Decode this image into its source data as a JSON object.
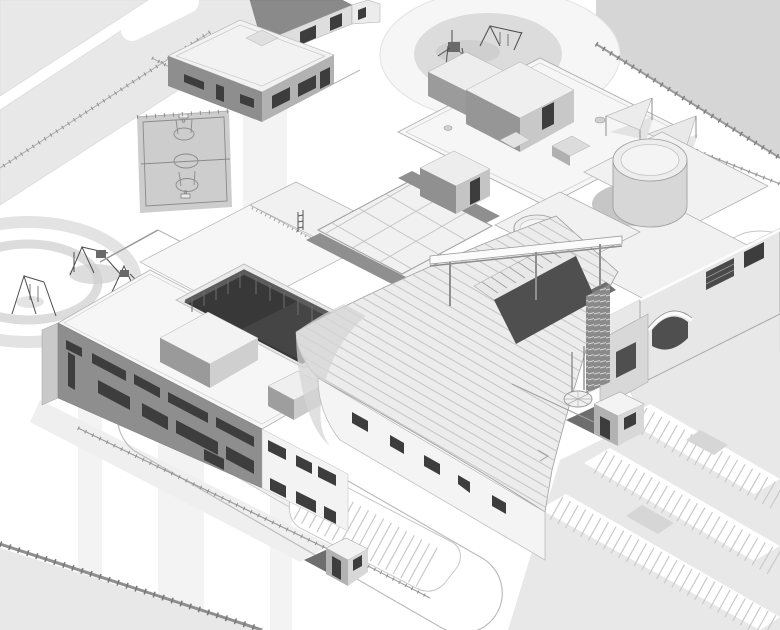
{
  "meta": {
    "title": "School campus — monochrome isometric architectural site render",
    "projection": "isometric axonometric, viewed from the south-east",
    "render_style": "white-model 3D massing render with thin grey line work, no visible text",
    "visible_text": "none"
  },
  "palette": {
    "bg": "#ffffff",
    "road": "#e8e8e8",
    "lot": "#d6d6d6",
    "stripe": "#f3f3f3",
    "ground-shadow": "#efefef",
    "court": "#cdcdcd",
    "court-line": "#8a8a8a",
    "ring": "#e3e3e3",
    "ring-inner": "#dcdcdc",
    "roof-white": "#f6f6f6",
    "roof-light": "#f1f1f1",
    "roof-mid": "#ececec",
    "facade-white": "#f4f4f4",
    "wall-dark": "#8e8e8e",
    "wall-mid": "#b2b2b2",
    "wall-light": "#d8d8d8",
    "wall-pale": "#e7e7e7",
    "glass-dark": "#3d3d3d",
    "courtyard-dark": "#383838",
    "recess-dark": "#4f4f4f",
    "drum-side": "#d7d7d7",
    "drum-top": "#ededed",
    "line": "#9a9a9a",
    "edge": "#b5b5b5",
    "fence": "#8f8f8f",
    "equipment": "#4d4d4d",
    "rib-line": "#c6c6c6",
    "grid-line": "#b9b9b9",
    "tick": "#c9c9c9",
    "booth-shadow": "#6e6e6e"
  },
  "features": {
    "scene": "School campus — monochrome isometric architectural site render",
    "west_wing": "West classroom wing, two-story block with dark facade and ribbon windows",
    "courtyard": "Sunken central courtyard with dark curtain-wall glazing",
    "atrium": "Glazed atrium court with skylight grid and parapet bands",
    "gym": "Gymnasium hall with curved ribbed metal roof",
    "east_wing": "East wing with arched entrance and rooftop rotunda",
    "drum_large": "Large cylindrical rotunda drum on east wing roof",
    "drum_small": "Small cylindrical drum on link roof",
    "ne_roof": "North-east roof terrace with stair penthouses, hatches and vents",
    "north_bar": "North classroom bar with roof parapet railing and ladder",
    "central_box": "Rooftop plant / stair box beside atrium",
    "basketball": "Fenced outdoor basketball court with painted markings",
    "playground_west": "West playground with circular paths and climbing equipment",
    "playground_ne": "North-east playground circle with swing set and climber",
    "shade_sails": "Triangular shade sails on posts near north-east fence",
    "outbuilding": "Detached north outbuilding (service shed) inside fenced yard",
    "neighbor": "Neighbouring building at the north site edge",
    "booth_east": "East gate guard booth with dark paving apron",
    "booth_south": "South gate guard booth with dark paving apron",
    "flag_circle": "Circular flag plaza with two flagpoles",
    "dropoff_loop": "Vehicular drop-off loop lane with centre island",
    "parking_se": "South-east surface parking rows with stall striping and planted islands",
    "parking_center": "Central parking bay with stall striping",
    "roads": "Perimeter roads, sidewalks and crosswalk paving bands",
    "fences": "Site boundary fences with regular posts",
    "entry_steps": "Main entry amphitheater steps with dark recessed entrance",
    "canopy": "Long white entry canopy beam on slender columns",
    "louver": "Vertical louver screen beside the main entrance",
    "roundabout": "Small turning circle at the east road edge"
  }
}
